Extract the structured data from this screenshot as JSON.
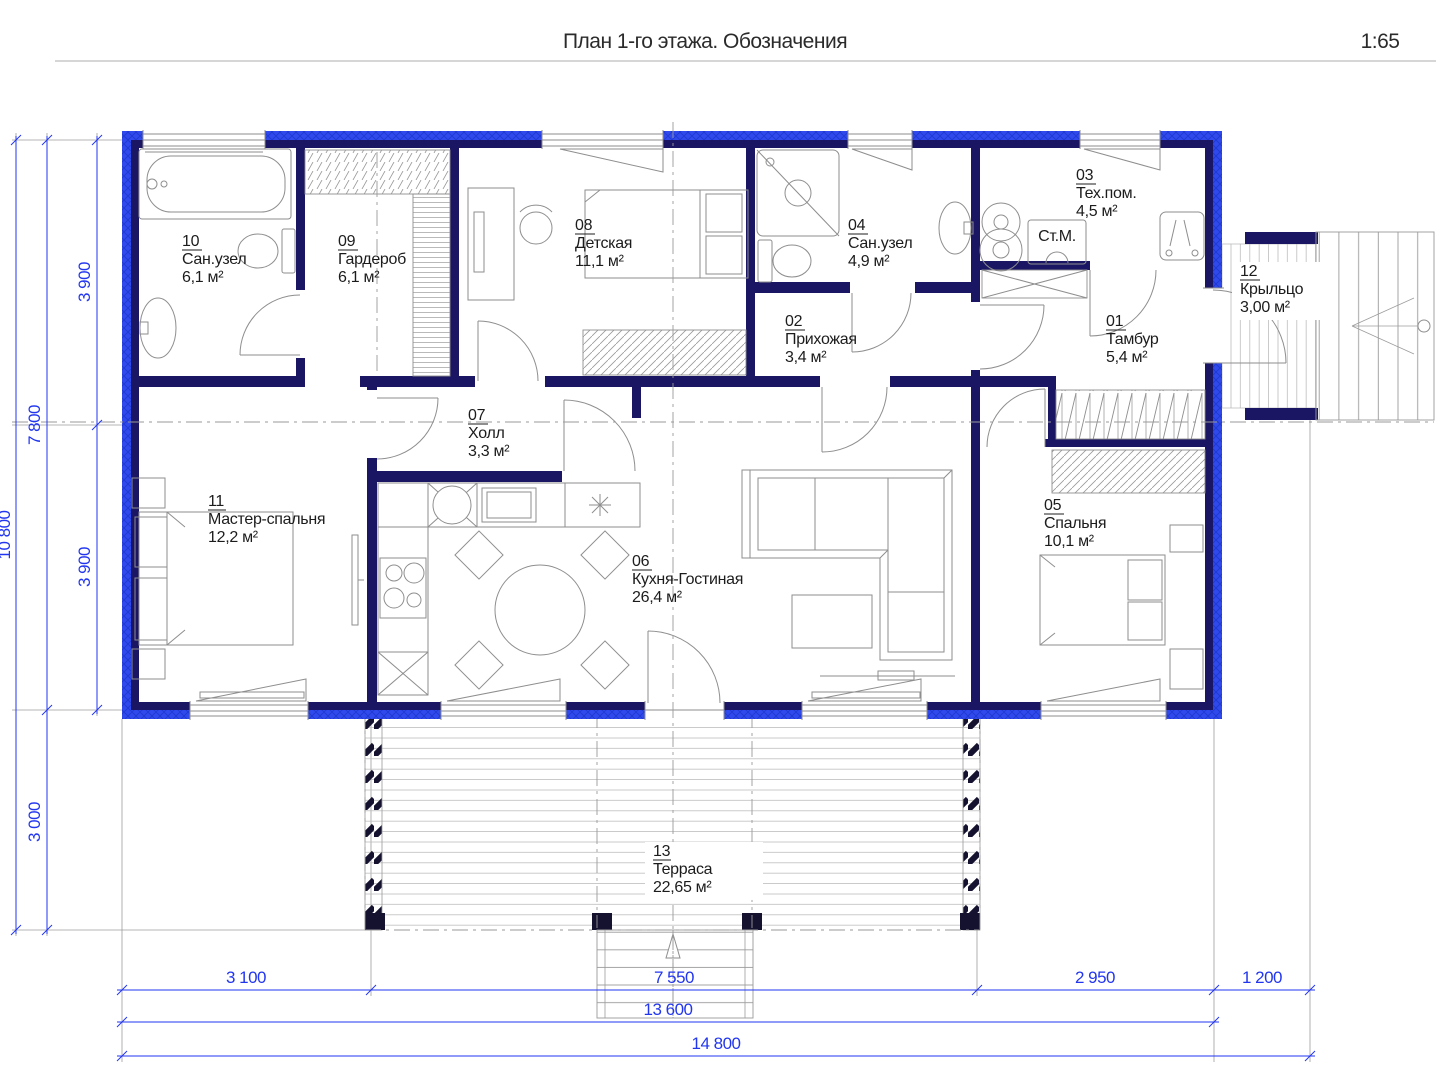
{
  "header": {
    "title": "План 1-го этажа. Обозначения",
    "scale": "1:65"
  },
  "rooms": {
    "r01": {
      "num": "01",
      "name": "Тамбур",
      "area": "5,4 м²"
    },
    "r02": {
      "num": "02",
      "name": "Прихожая",
      "area": "3,4 м²"
    },
    "r03": {
      "num": "03",
      "name": "Тех.пом.",
      "area": "4,5 м²"
    },
    "r04": {
      "num": "04",
      "name": "Сан.узел",
      "area": "4,9 м²"
    },
    "r05": {
      "num": "05",
      "name": "Спальня",
      "area": "10,1 м²"
    },
    "r06": {
      "num": "06",
      "name": "Кухня-Гостиная",
      "area": "26,4 м²"
    },
    "r07": {
      "num": "07",
      "name": "Холл",
      "area": "3,3 м²"
    },
    "r08": {
      "num": "08",
      "name": "Детская",
      "area": "11,1 м²"
    },
    "r09": {
      "num": "09",
      "name": "Гардероб",
      "area": "6,1 м²"
    },
    "r10": {
      "num": "10",
      "name": "Сан.узел",
      "area": "6,1 м²"
    },
    "r11": {
      "num": "11",
      "name": "Мастер-спальня",
      "area": "12,2 м²"
    },
    "r12": {
      "num": "12",
      "name": "Крыльцо",
      "area": "3,00 м²"
    },
    "r13": {
      "num": "13",
      "name": "Терраса",
      "area": "22,65 м²"
    }
  },
  "equipment": {
    "washing_machine_label": "Ст.М."
  },
  "dimensions": {
    "left_inner_top": "3 900",
    "left_inner_bottom": "3 900",
    "left_mid": "7 800",
    "left_terrace": "3 000",
    "left_total": "10 800",
    "bottom_seg1": "3 100",
    "bottom_seg2": "7 550",
    "bottom_seg3": "2 950",
    "bottom_seg4": "1 200",
    "bottom_sub": "13 600",
    "bottom_total": "14 800"
  },
  "colors": {
    "wall": "#1a1663",
    "insulation": "#2f49ec",
    "dimension": "#2236f0"
  }
}
